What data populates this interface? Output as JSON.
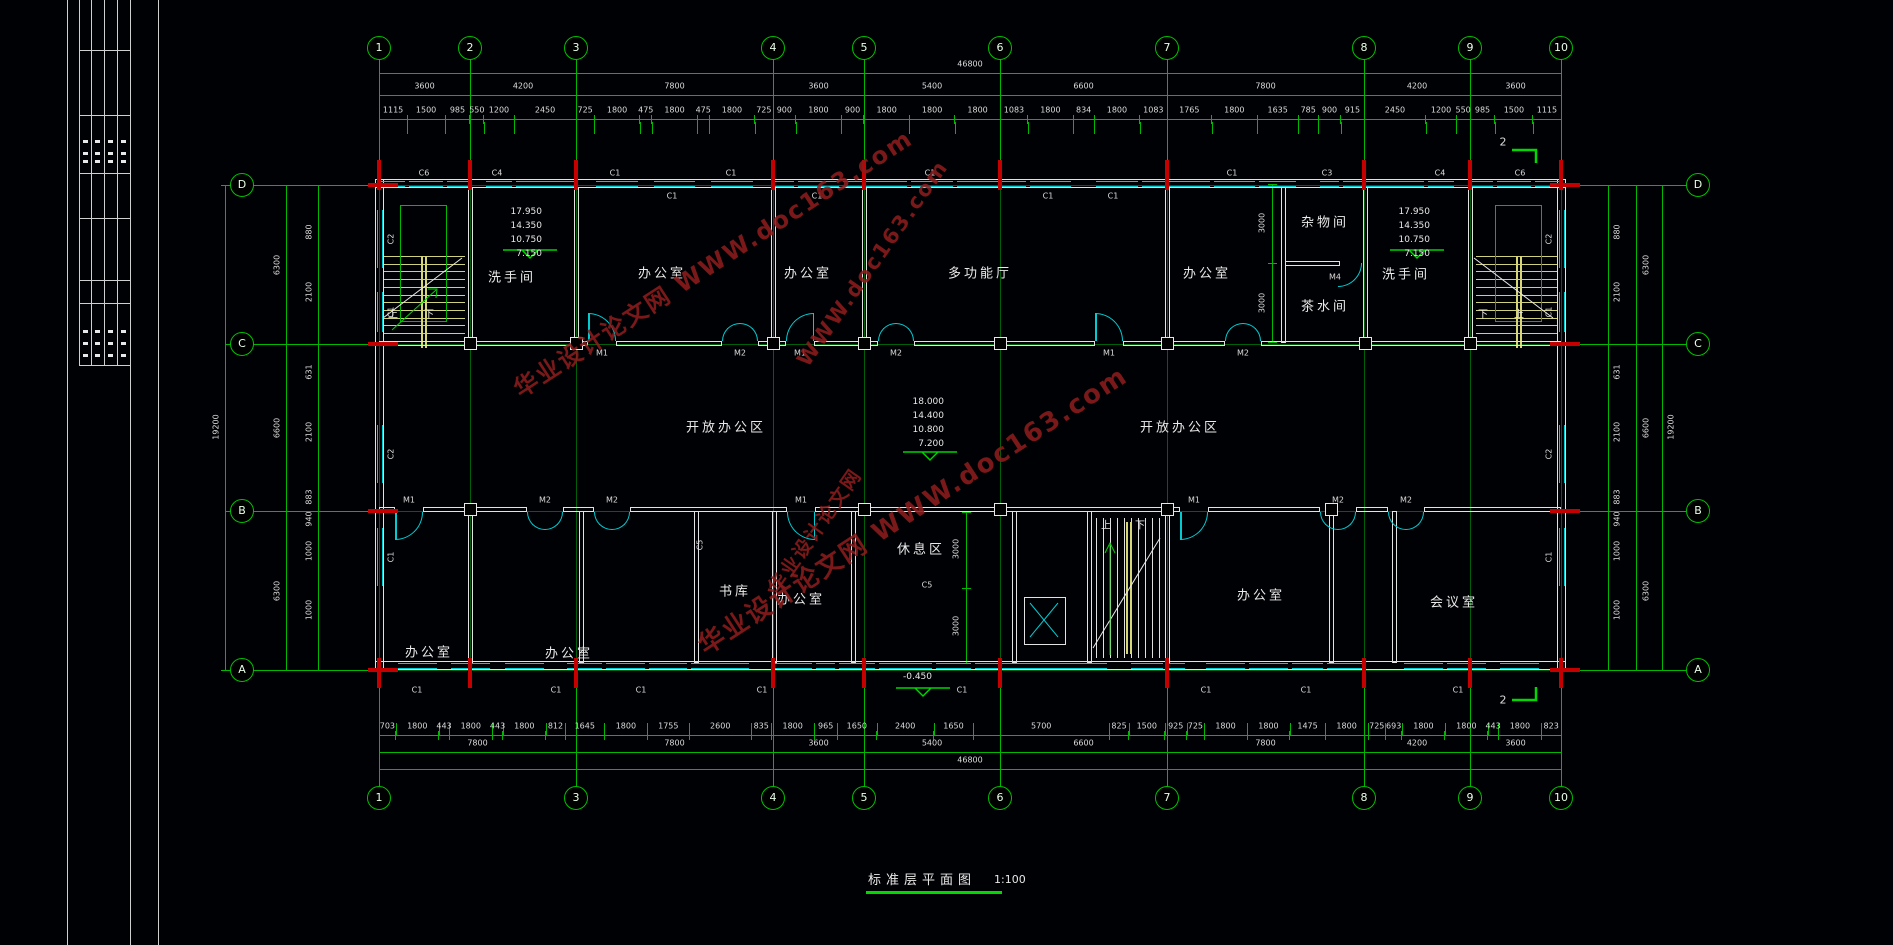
{
  "drawing": {
    "title": "标准层平面图",
    "scale": "1:100"
  },
  "watermark": {
    "text": "华业设计论文网",
    "url": "WWW.doc163.com",
    "color": "#8c1c1c"
  },
  "axes": {
    "top_numbers": [
      "1",
      "2",
      "3",
      "4",
      "5",
      "6",
      "7",
      "8",
      "9",
      "10"
    ],
    "bottom_numbers": [
      "1",
      "3",
      "4",
      "5",
      "6",
      "7",
      "8",
      "9",
      "10"
    ],
    "row_letters": [
      "D",
      "C",
      "B",
      "A"
    ],
    "overall_width": "46800",
    "overall_height": "19200",
    "top_segments": [
      "3600",
      "4200",
      "7800",
      "3600",
      "5400",
      "6600",
      "7800",
      "4200",
      "3600"
    ],
    "bottom_segments": [
      "7800",
      "7800",
      "3600",
      "5400",
      "6600",
      "7800",
      "4200",
      "3600"
    ],
    "top_small_dims": [
      "1115",
      "1500",
      "985",
      "550",
      "1200",
      "2450",
      "725",
      "1800",
      "475",
      "1800",
      "475",
      "1800",
      "725",
      "900",
      "1800",
      "900",
      "1800",
      "1800",
      "1800",
      "1083",
      "1800",
      "834",
      "1800",
      "1083",
      "1765",
      "1800",
      "1635",
      "785",
      "900",
      "915",
      "2450",
      "1200",
      "550",
      "985",
      "1500",
      "1115"
    ],
    "bottom_small_dims": [
      "703",
      "1800",
      "443",
      "1800",
      "443",
      "1800",
      "812",
      "1645",
      "1800",
      "1755",
      "2600",
      "835",
      "1800",
      "965",
      "1650",
      "2400",
      "1650",
      "5700",
      "825",
      "1500",
      "925",
      "725",
      "1800",
      "1800",
      "1475",
      "1800",
      "725",
      "693",
      "1800",
      "1800",
      "443",
      "1800",
      "823"
    ],
    "left_segments": [
      "6300",
      "6600",
      "6300"
    ],
    "right_segments": [
      "6300",
      "6600",
      "6300"
    ],
    "left_small_dims": [
      "880",
      "2100",
      "631",
      "2100",
      "883",
      "940",
      "1000",
      "1000"
    ],
    "right_small_dims": [
      "880",
      "2100",
      "631",
      "2100",
      "883",
      "940",
      "1000",
      "1000"
    ]
  },
  "rooms": [
    {
      "label": "洗手间",
      "x": 512,
      "y": 276
    },
    {
      "label": "办公室",
      "x": 662,
      "y": 272
    },
    {
      "label": "办公室",
      "x": 808,
      "y": 272
    },
    {
      "label": "多功能厅",
      "x": 980,
      "y": 272
    },
    {
      "label": "办公室",
      "x": 1207,
      "y": 272
    },
    {
      "label": "杂物间",
      "x": 1325,
      "y": 221
    },
    {
      "label": "茶水间",
      "x": 1325,
      "y": 305
    },
    {
      "label": "洗手间",
      "x": 1406,
      "y": 273
    },
    {
      "label": "开放办公区",
      "x": 726,
      "y": 426
    },
    {
      "label": "开放办公区",
      "x": 1180,
      "y": 426
    },
    {
      "label": "办公室",
      "x": 429,
      "y": 651
    },
    {
      "label": "办公室",
      "x": 569,
      "y": 652
    },
    {
      "label": "书库",
      "x": 735,
      "y": 590
    },
    {
      "label": "办公室",
      "x": 801,
      "y": 598
    },
    {
      "label": "休息区",
      "x": 921,
      "y": 548
    },
    {
      "label": "办公室",
      "x": 1261,
      "y": 594
    },
    {
      "label": "会议室",
      "x": 1454,
      "y": 601
    }
  ],
  "levels": {
    "left": [
      "17.950",
      "14.350",
      "10.750",
      "7.150"
    ],
    "center": [
      "18.000",
      "14.400",
      "10.800",
      "7.200"
    ],
    "right": [
      "17.950",
      "14.350",
      "10.750",
      "7.150"
    ],
    "ground": "-0.450"
  },
  "stair_labels": {
    "up": "上",
    "down": "下"
  },
  "window_labels": {
    "top_above": [
      {
        "t": "C6",
        "x": 424
      },
      {
        "t": "C4",
        "x": 497
      },
      {
        "t": "C1",
        "x": 615
      },
      {
        "t": "C1",
        "x": 731
      },
      {
        "t": "C1",
        "x": 930
      },
      {
        "t": "C1",
        "x": 1232
      },
      {
        "t": "C3",
        "x": 1327
      },
      {
        "t": "C4",
        "x": 1440
      },
      {
        "t": "C6",
        "x": 1520
      }
    ],
    "top_below": [
      {
        "t": "C1",
        "x": 672
      },
      {
        "t": "C1",
        "x": 817
      },
      {
        "t": "C1",
        "x": 1048
      },
      {
        "t": "C1",
        "x": 1113
      }
    ],
    "bottom": [
      {
        "t": "C1",
        "x": 417
      },
      {
        "t": "C1",
        "x": 556
      },
      {
        "t": "C1",
        "x": 641
      },
      {
        "t": "C1",
        "x": 762
      },
      {
        "t": "C1",
        "x": 962
      },
      {
        "t": "C1",
        "x": 1206
      },
      {
        "t": "C1",
        "x": 1306
      },
      {
        "t": "C1",
        "x": 1458
      }
    ],
    "left": [
      "C2",
      "C1",
      "C2",
      "C1"
    ],
    "right": [
      "C2",
      "C1",
      "C2",
      "C1"
    ],
    "interior": [
      "C5",
      "C5"
    ]
  },
  "door_labels": {
    "wallC": [
      {
        "t": "M1",
        "x": 602
      },
      {
        "t": "M2",
        "x": 740
      },
      {
        "t": "M1",
        "x": 800
      },
      {
        "t": "M2",
        "x": 896
      },
      {
        "t": "M1",
        "x": 1109
      },
      {
        "t": "M2",
        "x": 1243
      }
    ],
    "wallB": [
      {
        "t": "M1",
        "x": 409
      },
      {
        "t": "M2",
        "x": 545
      },
      {
        "t": "M2",
        "x": 612
      },
      {
        "t": "M1",
        "x": 801
      },
      {
        "t": "M1",
        "x": 1194
      },
      {
        "t": "M2",
        "x": 1338
      },
      {
        "t": "M2",
        "x": 1406
      }
    ],
    "m4": "M4"
  },
  "aux_dims": [
    "3000",
    "3000",
    "3000",
    "3000"
  ],
  "section_marker": "2",
  "colors": {
    "line": "#00b800",
    "dimline": "#006007",
    "white": "#e6e6e6",
    "cyan": "#00ccd2",
    "yellow": "#d6d676",
    "red": "#c40000",
    "level": "#00d400",
    "watermark": "#8c1c1c"
  }
}
